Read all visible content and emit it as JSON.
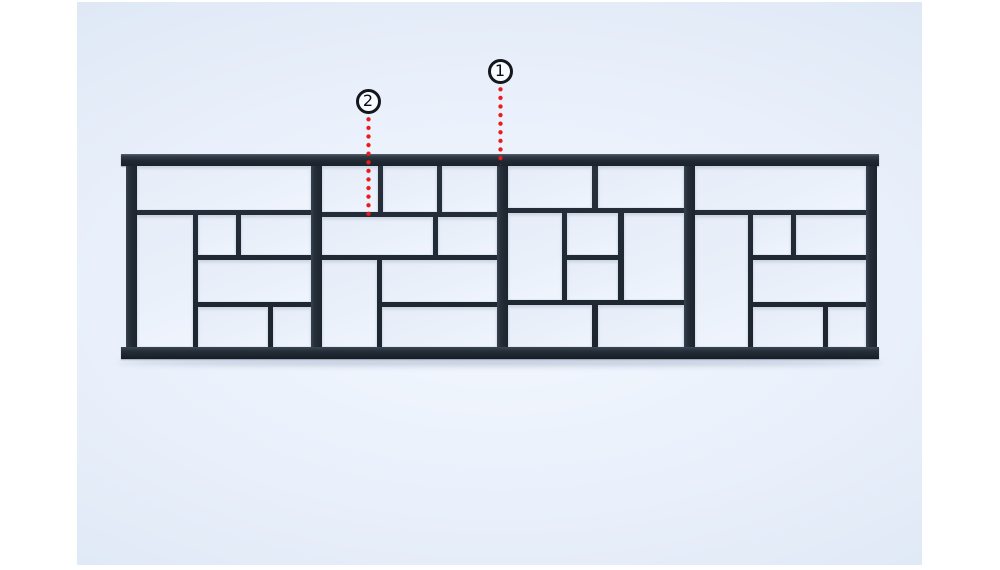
{
  "figure": {
    "kind": "3d-render-of-railing-panel-with-numbered-callouts",
    "visible_text": [
      "1",
      "2"
    ]
  },
  "colors": {
    "frame": "#212a34",
    "cell": "#eaf0fa",
    "bg_center": "#f3f7fe",
    "bg_edge": "#d5dfef",
    "red": "#ec1b1b",
    "ring": "#14171b",
    "page": "#ffffff"
  },
  "railing": {
    "top_rail": {
      "x": 44,
      "y": 152,
      "w": 758,
      "h": 12
    },
    "bottom_rail": {
      "x": 44,
      "y": 345,
      "w": 758,
      "h": 12
    },
    "posts": [
      {
        "x": 49
      },
      {
        "x": 234
      },
      {
        "x": 420
      },
      {
        "x": 607
      },
      {
        "x": 789
      }
    ],
    "panels": [
      {
        "name": "panel-1",
        "x": 60,
        "w": 174,
        "cells": [
          [
            0,
            0,
            174,
            44
          ],
          [
            0,
            49,
            56,
            132
          ],
          [
            61,
            49,
            38,
            40
          ],
          [
            104,
            49,
            70,
            40
          ],
          [
            61,
            94,
            113,
            42
          ],
          [
            61,
            141,
            70,
            40
          ],
          [
            136,
            141,
            38,
            40
          ]
        ]
      },
      {
        "name": "panel-2",
        "x": 245,
        "w": 175,
        "cells": [
          [
            0,
            0,
            56,
            46
          ],
          [
            61,
            0,
            54,
            46
          ],
          [
            120,
            0,
            55,
            46
          ],
          [
            0,
            51,
            111,
            38
          ],
          [
            116,
            51,
            59,
            38
          ],
          [
            0,
            94,
            55,
            87
          ],
          [
            60,
            94,
            115,
            42
          ],
          [
            60,
            141,
            115,
            40
          ]
        ]
      },
      {
        "name": "panel-3",
        "x": 431,
        "w": 176,
        "cells": [
          [
            0,
            0,
            84,
            42
          ],
          [
            90,
            0,
            86,
            42
          ],
          [
            0,
            47,
            54,
            87
          ],
          [
            59,
            47,
            51,
            42
          ],
          [
            59,
            94,
            51,
            40
          ],
          [
            116,
            47,
            60,
            87
          ],
          [
            0,
            139,
            84,
            42
          ],
          [
            90,
            139,
            86,
            42
          ]
        ]
      },
      {
        "name": "panel-4",
        "x": 618,
        "w": 171,
        "cells": [
          [
            0,
            0,
            171,
            44
          ],
          [
            0,
            49,
            53,
            132
          ],
          [
            58,
            49,
            38,
            40
          ],
          [
            101,
            49,
            70,
            40
          ],
          [
            58,
            94,
            113,
            42
          ],
          [
            58,
            141,
            70,
            40
          ],
          [
            133,
            141,
            38,
            40
          ]
        ]
      }
    ]
  },
  "callouts": [
    {
      "label": "1",
      "cx": 423,
      "cy": 69,
      "line_x": 421,
      "line_top": 83,
      "line_h": 80,
      "points_to": "top-rail"
    },
    {
      "label": "2",
      "cx": 291,
      "cy": 99,
      "line_x": 289,
      "line_top": 113,
      "line_h": 101,
      "points_to": "pattern-crossbar"
    }
  ]
}
